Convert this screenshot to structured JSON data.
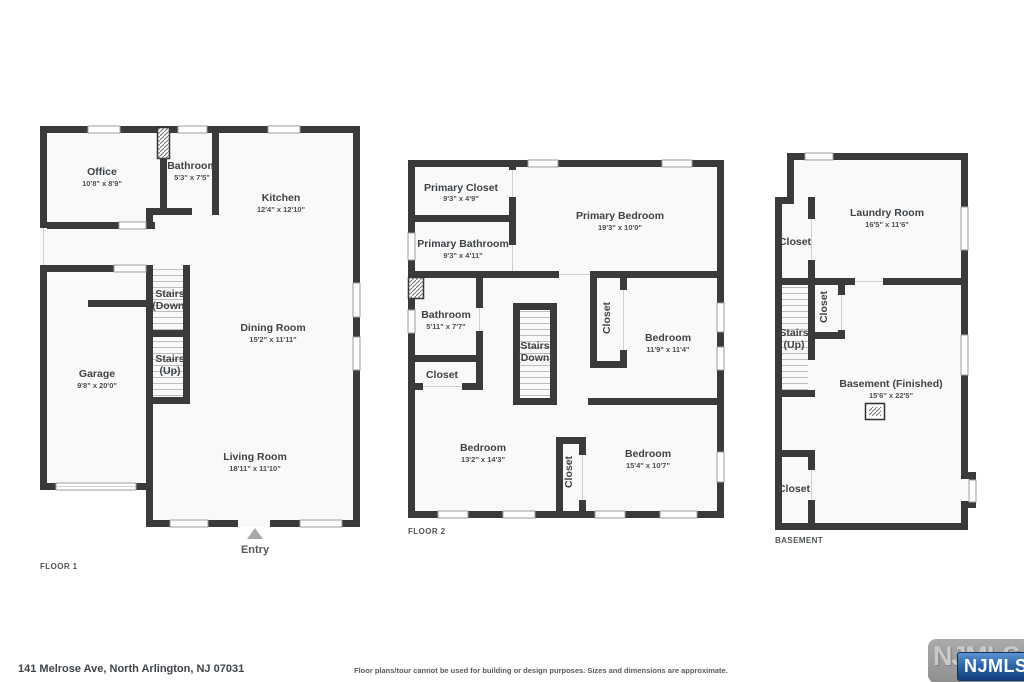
{
  "footer": {
    "address": "141 Melrose Ave, North Arlington, NJ 07031",
    "disclaimer": "Floor plans/tour cannot be used for building or design purposes. Sizes and dimensions are approximate."
  },
  "branding": {
    "watermark": "NJMLS",
    "badge": "NJMLS"
  },
  "floor1": {
    "label": "FLOOR 1",
    "entry_label": "Entry",
    "office": {
      "name": "Office",
      "dims": "10'8\" x 8'9\""
    },
    "bathroom": {
      "name": "Bathroom",
      "dims": "5'3\" x 7'5\""
    },
    "kitchen": {
      "name": "Kitchen",
      "dims": "12'4\" x 12'10\""
    },
    "stairs_down": {
      "line1": "Stairs",
      "line2": "(Down)"
    },
    "stairs_up": {
      "line1": "Stairs",
      "line2": "(Up)"
    },
    "dining": {
      "name": "Dining Room",
      "dims": "15'2\" x 11'11\""
    },
    "garage": {
      "name": "Garage",
      "dims": "9'8\" x 20'0\""
    },
    "living": {
      "name": "Living Room",
      "dims": "18'11\" x 11'10\""
    }
  },
  "floor2": {
    "label": "FLOOR 2",
    "primary_closet": {
      "name": "Primary Closet",
      "dims": "9'3\" x 4'9\""
    },
    "primary_bathroom": {
      "name": "Primary Bathroom",
      "dims": "9'3\" x 4'11\""
    },
    "primary_bedroom": {
      "name": "Primary Bedroom",
      "dims": "19'3\" x 10'0\""
    },
    "bathroom": {
      "name": "Bathroom",
      "dims": "5'11\" x 7'7\""
    },
    "stairs_down": {
      "line1": "Stairs",
      "line2": "(Down)"
    },
    "closet_hall": "Closet",
    "closet_left": "Closet",
    "closet_mid": "Closet",
    "bedroom_right": {
      "name": "Bedroom",
      "dims": "11'9\" x 11'4\""
    },
    "bedroom_bl": {
      "name": "Bedroom",
      "dims": "13'2\" x 14'3\""
    },
    "bedroom_br": {
      "name": "Bedroom",
      "dims": "15'4\" x 10'7\""
    }
  },
  "basement": {
    "label": "BASEMENT",
    "laundry": {
      "name": "Laundry Room",
      "dims": "16'5\" x 11'6\""
    },
    "closet_upper": "Closet",
    "closet_stairs": "Closet",
    "stairs_up": {
      "line1": "Stairs",
      "line2": "(Up)"
    },
    "finished": {
      "name": "Basement (Finished)",
      "dims": "15'6\" x 22'5\""
    },
    "closet_lower": "Closet"
  }
}
